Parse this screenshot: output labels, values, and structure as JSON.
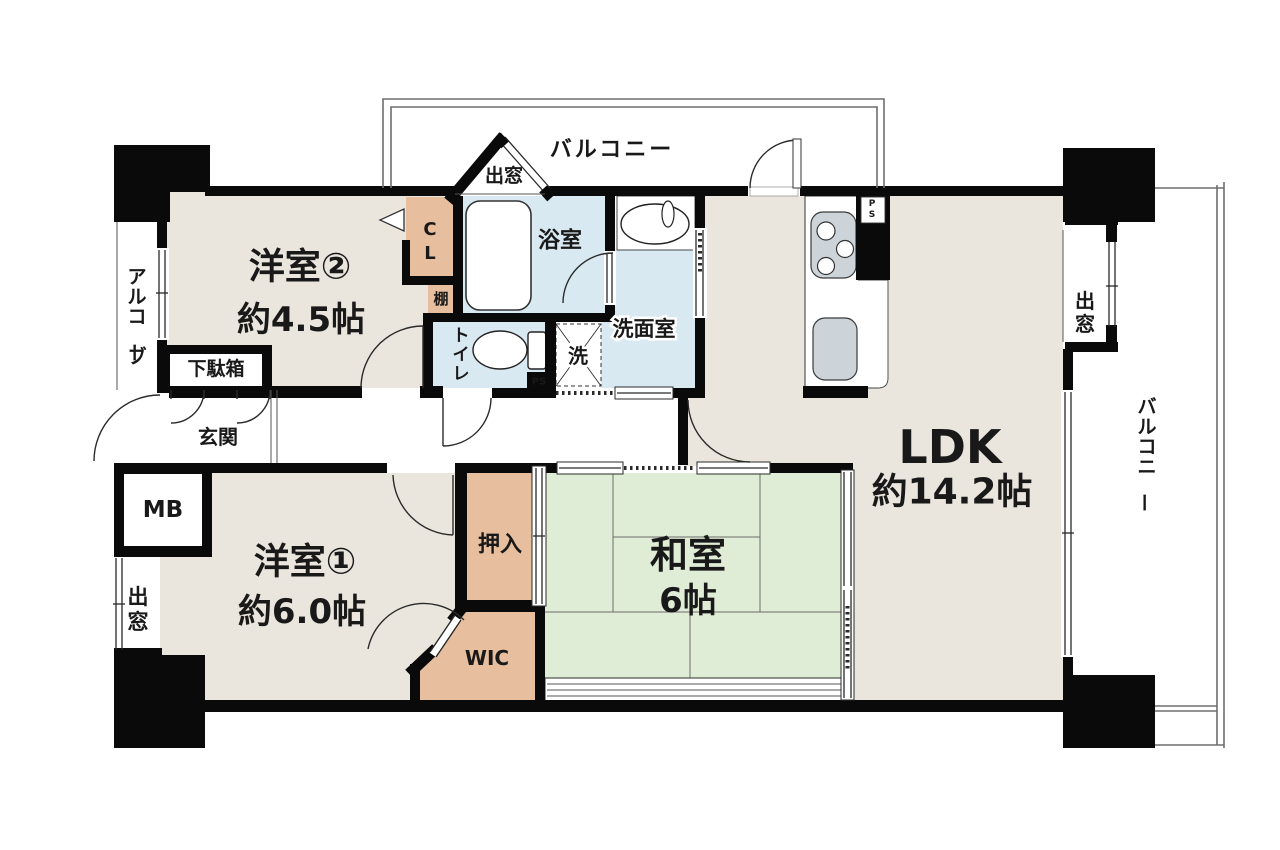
{
  "title": "マンション間取り図 3LDK",
  "colors": {
    "wall": "#0a0a0a",
    "floor": "#eae6dd",
    "tatami": "#e0edd6",
    "water": "#d9e9f2",
    "closet": "#e8bf9e",
    "fixture": "#cdd4d9"
  },
  "rooms": {
    "western2": {
      "name": "洋室②",
      "size": "約4.5帖"
    },
    "western1": {
      "name": "洋室①",
      "size": "約6.0帖"
    },
    "japanese": {
      "name": "和室",
      "size": "6帖"
    },
    "ldk": {
      "name": "LDK",
      "size": "約14.2帖"
    },
    "bathroom": "浴室",
    "washroom": "洗面室",
    "toilet": "トイレ",
    "washer": "洗",
    "closet": "CL",
    "shelf": "棚",
    "oshiire": "押入",
    "wic": "WIC",
    "entrance": "玄関",
    "shoe_cabinet": "下駄箱",
    "meter_box": "MB",
    "alcove": "アルコーブ",
    "balcony": "バルコニー",
    "bay_window": "出窓",
    "pipe_space": "PS"
  }
}
